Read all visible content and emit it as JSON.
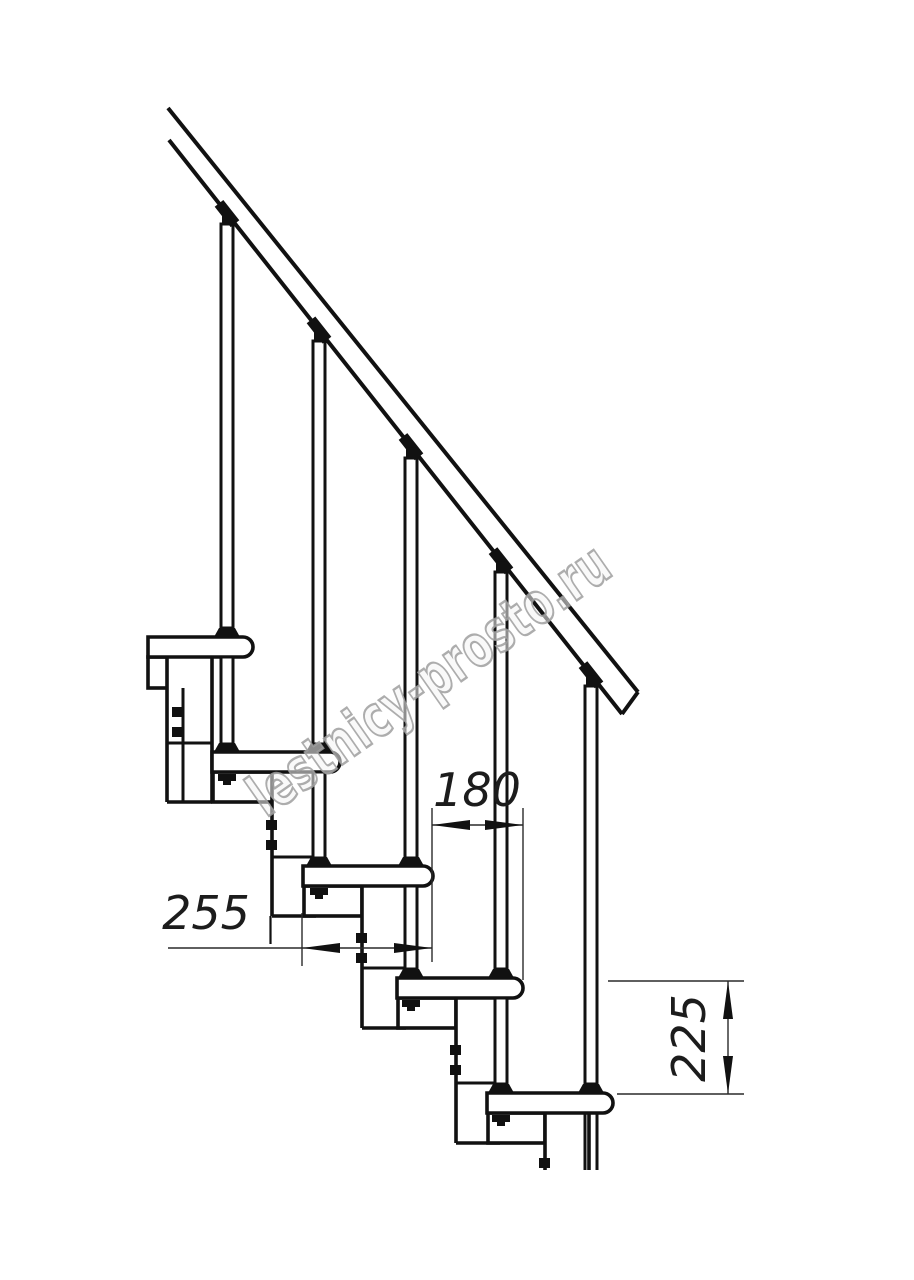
{
  "title": "modular staircase side-view technical drawing",
  "watermark": {
    "text": "lestnicy-prosto.ru"
  },
  "dimensions": {
    "going": {
      "label": "180",
      "value_mm": 180,
      "meaning": "horizontal offset between consecutive steps"
    },
    "tread_depth": {
      "label": "255",
      "value_mm": 255,
      "meaning": "full tread depth"
    },
    "riser": {
      "label": "225",
      "value_mm": 225,
      "meaning": "riser height between treads"
    }
  },
  "structure": {
    "steps_visible": 5,
    "balusters_visible": 5,
    "handrail": "diagonal round handrail, cut square at lower end",
    "support": "central modular column under each tread with two side bolts"
  },
  "colors": {
    "background": "#ffffff",
    "line": "#111111",
    "dimension_line": "#2a2a2a",
    "watermark_stroke": "#9f9f9f",
    "watermark_fill": "#f4f4f4"
  }
}
